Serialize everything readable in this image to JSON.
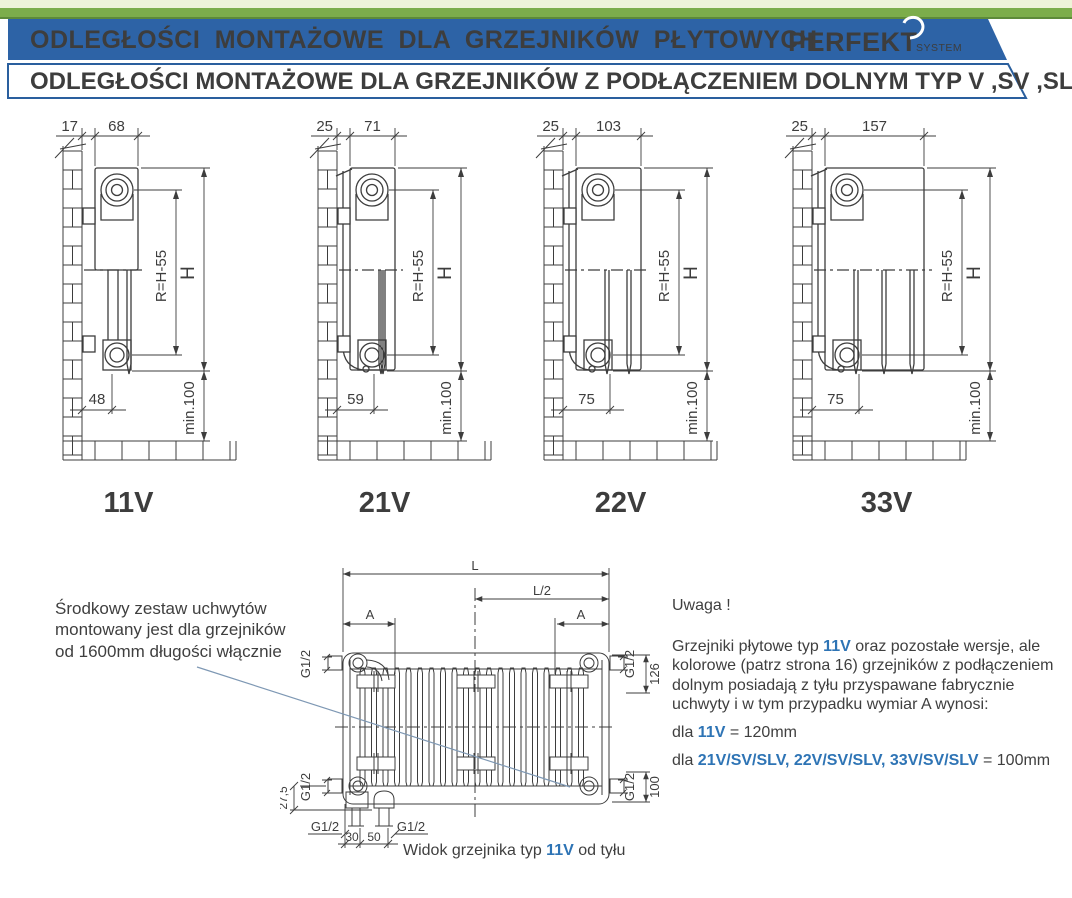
{
  "colors": {
    "banner_blue": "#2d63a6",
    "banner_text": "#eaf5f3",
    "title2_blue": "#2a5f9e",
    "accent_blue": "#2e74b5",
    "label_blue": "#2b5d9e",
    "green": "#7cad4b",
    "green_dark": "#5d8a3a",
    "cream": "#eef3d8",
    "line": "#3d3d3d",
    "leader": "#7e98b4",
    "text": "#3f3f3f"
  },
  "header": {
    "title1": "ODLEGŁOŚCI MONTAŻOWE DLA GRZEJNIKÓW PŁYTOWYCH",
    "logo_brand": "PERFEKT",
    "logo_sub": "SYSTEM",
    "title2": "ODLEGŁOŚCI MONTAŻOWE DLA GRZEJNIKÓW Z PODŁĄCZENIEM DOLNYM TYP V ,SV ,SLV"
  },
  "diagrams": [
    {
      "type_label": "11V",
      "wall_gap": "17",
      "depth": "68",
      "bottom": "48",
      "radius": "R=H-55",
      "height": "H",
      "floor": "min.100",
      "depth_px": 43,
      "bottom_px": 30,
      "plates": 1,
      "cover": false
    },
    {
      "type_label": "21V",
      "wall_gap": "25",
      "depth": "71",
      "bottom": "59",
      "radius": "R=H-55",
      "height": "H",
      "floor": "min.100",
      "depth_px": 45,
      "bottom_px": 37,
      "plates": 2,
      "cover": true
    },
    {
      "type_label": "22V",
      "wall_gap": "25",
      "depth": "103",
      "bottom": "75",
      "radius": "R=H-55",
      "height": "H",
      "floor": "min.100",
      "depth_px": 65,
      "bottom_px": 47,
      "plates": 2,
      "cover": true
    },
    {
      "type_label": "33V",
      "wall_gap": "25",
      "depth": "157",
      "bottom": "75",
      "radius": "R=H-55",
      "height": "H",
      "floor": "min.100",
      "depth_px": 99,
      "bottom_px": 47,
      "plates": 3,
      "cover": true
    }
  ],
  "rear_view": {
    "dims": {
      "length": "L",
      "half_length": "L/2",
      "bracket_offset": "A",
      "conn": "G1/2",
      "top_offset": "126",
      "bottom_offset": "100",
      "foot": "27,5",
      "stub1": "30",
      "stub2": "50"
    },
    "caption_prefix": "Widok grzejnika typ ",
    "caption_type": "11V",
    "caption_suffix": " od tyłu"
  },
  "notes": {
    "left_lines": [
      "Środkowy zestaw uchwytów",
      "montowany jest dla grzejników",
      "od 1600mm długości włącznie"
    ],
    "right": {
      "title": "Uwaga !",
      "p1_prefix": "Grzejniki płytowe typ ",
      "p1_highlight": "11V",
      "p1_suffix": " oraz pozostałe wersje, ale kolorowe (patrz strona 16) grzejników z podłączeniem dolnym posiadają z tyłu przyspawane fabrycznie uchwyty i w tym przypadku wymiar A wynosi:",
      "l1_prefix": "dla ",
      "l1_highlight": "11V",
      "l1_suffix": " = 120mm",
      "l2_prefix": "dla ",
      "l2_highlight": "21V/SV/SLV, 22V/SV/SLV, 33V/SV/SLV",
      "l2_suffix": " = 100mm"
    }
  }
}
